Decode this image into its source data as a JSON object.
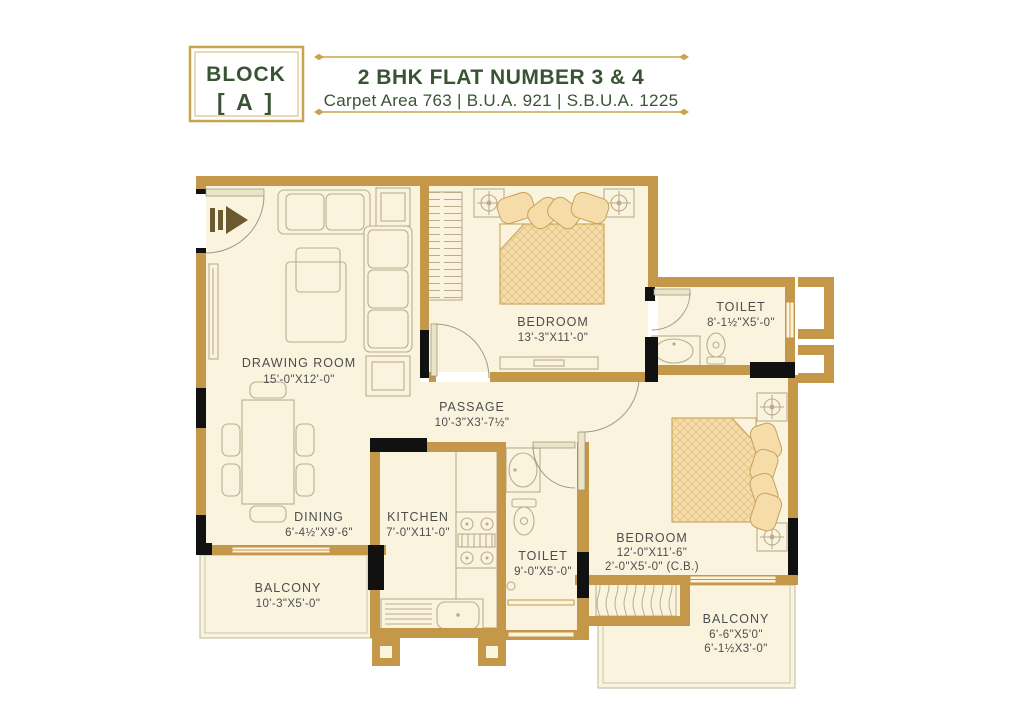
{
  "header": {
    "block_label": "BLOCK",
    "block_letter": "[ A ]",
    "title": "2 BHK FLAT NUMBER 3 & 4",
    "subtitle": "Carpet Area 763 | B.U.A. 921 | S.B.U.A. 1225"
  },
  "rooms": {
    "drawing_room": {
      "name": "DRAWING ROOM",
      "size": "15'-0\"X12'-0\""
    },
    "bedroom1": {
      "name": "BEDROOM",
      "size": "13'-3\"X11'-0\""
    },
    "toilet1": {
      "name": "TOILET",
      "size": "8'-1½\"X5'-0\""
    },
    "passage": {
      "name": "PASSAGE",
      "size": "10'-3\"X3'-7½\""
    },
    "dining": {
      "name": "DINING",
      "size": "6'-4½\"X9'-6\""
    },
    "kitchen": {
      "name": "KITCHEN",
      "size": "7'-0\"X11'-0\""
    },
    "toilet2": {
      "name": "TOILET",
      "size": "9'-0\"X5'-0\""
    },
    "bedroom2": {
      "name": "BEDROOM",
      "size": "12'-0\"X11'-6\"",
      "size2": "2'-0\"X5'-0\" (C.B.)"
    },
    "balcony1": {
      "name": "BALCONY",
      "size": "10'-3\"X5'-0\""
    },
    "balcony2": {
      "name": "BALCONY",
      "size": "6'-6\"X5'0\"",
      "size2": "6'-1½X3'-0\""
    }
  },
  "colors": {
    "wall": "#C59849",
    "column": "#111111",
    "floor": "#FAF4DF",
    "furniture": "#B9AD8E",
    "bed": "#F5DCA8",
    "bedline": "#C9A158",
    "thin": "#C9C2AC",
    "label": "#4D4D4D",
    "green": "#3A5334",
    "gold": "#C9A44E"
  }
}
